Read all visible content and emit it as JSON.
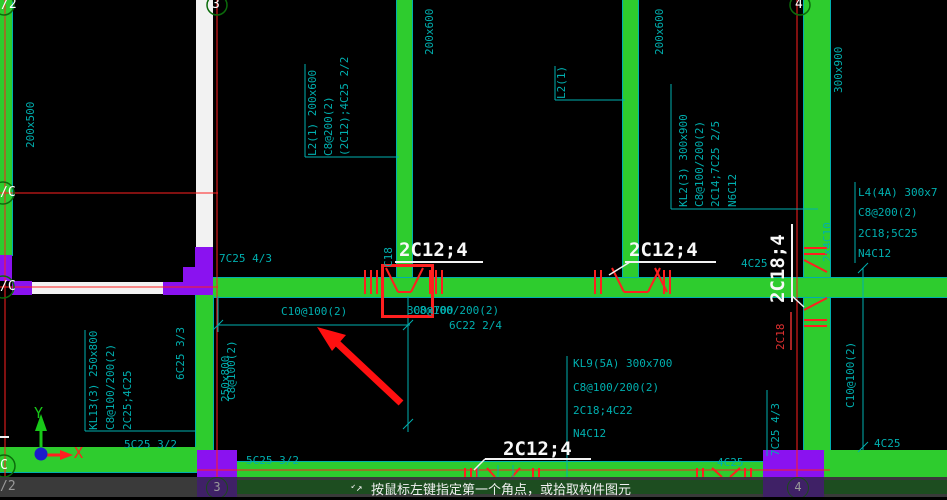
{
  "grid": {
    "bubble_top_left": "/2",
    "bubble_3": "3",
    "bubble_4": "4",
    "bubble_row_c_upper": "/C",
    "bubble_row_c_lower": "/C",
    "bubble_bottom_left": "C",
    "status_bubble_left": "/2",
    "status_bubble_3": "3",
    "status_bubble_4": "4"
  },
  "ucs": {
    "x_label": "X",
    "y_label": "Y"
  },
  "annotations": {
    "left_beam_size": "200x500",
    "l2a_line1": "L2(1) 200x600",
    "l2a_line2": "C8@200(2)",
    "l2a_line3": "(2C12);4C25 2/2",
    "beam_a_size": "200x600",
    "l2b_label": "L2(1)",
    "beam_b_size": "200x600",
    "kl2_line1": "KL2(3) 300x900",
    "kl2_line2": "C8@100/200(2)",
    "kl2_line3": "2C14;7C25 2/5",
    "kl2_line4": "N6C12",
    "beam_c_size": "300x900",
    "l4_line1": "L4(4A) 300x7",
    "l4_line2": "C8@200(2)",
    "l4_line3": "2C18;5C25",
    "l4_line4": "N4C12",
    "support_7c25_top": "7C25 4/3",
    "label_2c12_4": "2C12;4",
    "label_2c18_4": "2C18;4",
    "c18_small": "C18",
    "red_2c18": "2C18",
    "two_by_4c10": "2x4C10",
    "support_4c25_mid": "4C25",
    "support_4c25_right": "4C25",
    "support_4c25_bottom": "4C25",
    "dim_c10": "C10@100(2)",
    "overlap_h1": "300x700",
    "overlap_h2": "C8@100/200(2)",
    "span_6c22": "6C22 2/4",
    "kl9_line1": "KL9(5A) 300x700",
    "kl9_line2": "C8@100/200(2)",
    "kl9_line3": "2C18;4C22",
    "kl9_line4": "N4C12",
    "kl13_line1": "KL13(3) 250x800",
    "kl13_line2": "C8@100/200(2)",
    "kl13_line3": "2C25;4C25",
    "span_6c25": "6C25 3/3",
    "overlap_v1": "250x800",
    "overlap_v2": "C8@100(2)",
    "support_5c25": "5C25 3/2",
    "support_7c25_right": "7C25 4/3"
  },
  "status_bar": {
    "cursor_glyph": "↗",
    "cursor_glyph2": "↙",
    "message": "按鼠标左键指定第一个角点，或拾取构件图元"
  },
  "colors": {
    "beam_green": "#2ECC2E",
    "column_purple": "#8A12F0",
    "annotation_cyan": "#00AFAF",
    "gridline_red": "#FF1F1F",
    "wall_white": "#F2F2F2",
    "white_label": "#F8F8F8",
    "status_bg": "#3A3A3A",
    "bubble_green": "#0B6B0B"
  }
}
